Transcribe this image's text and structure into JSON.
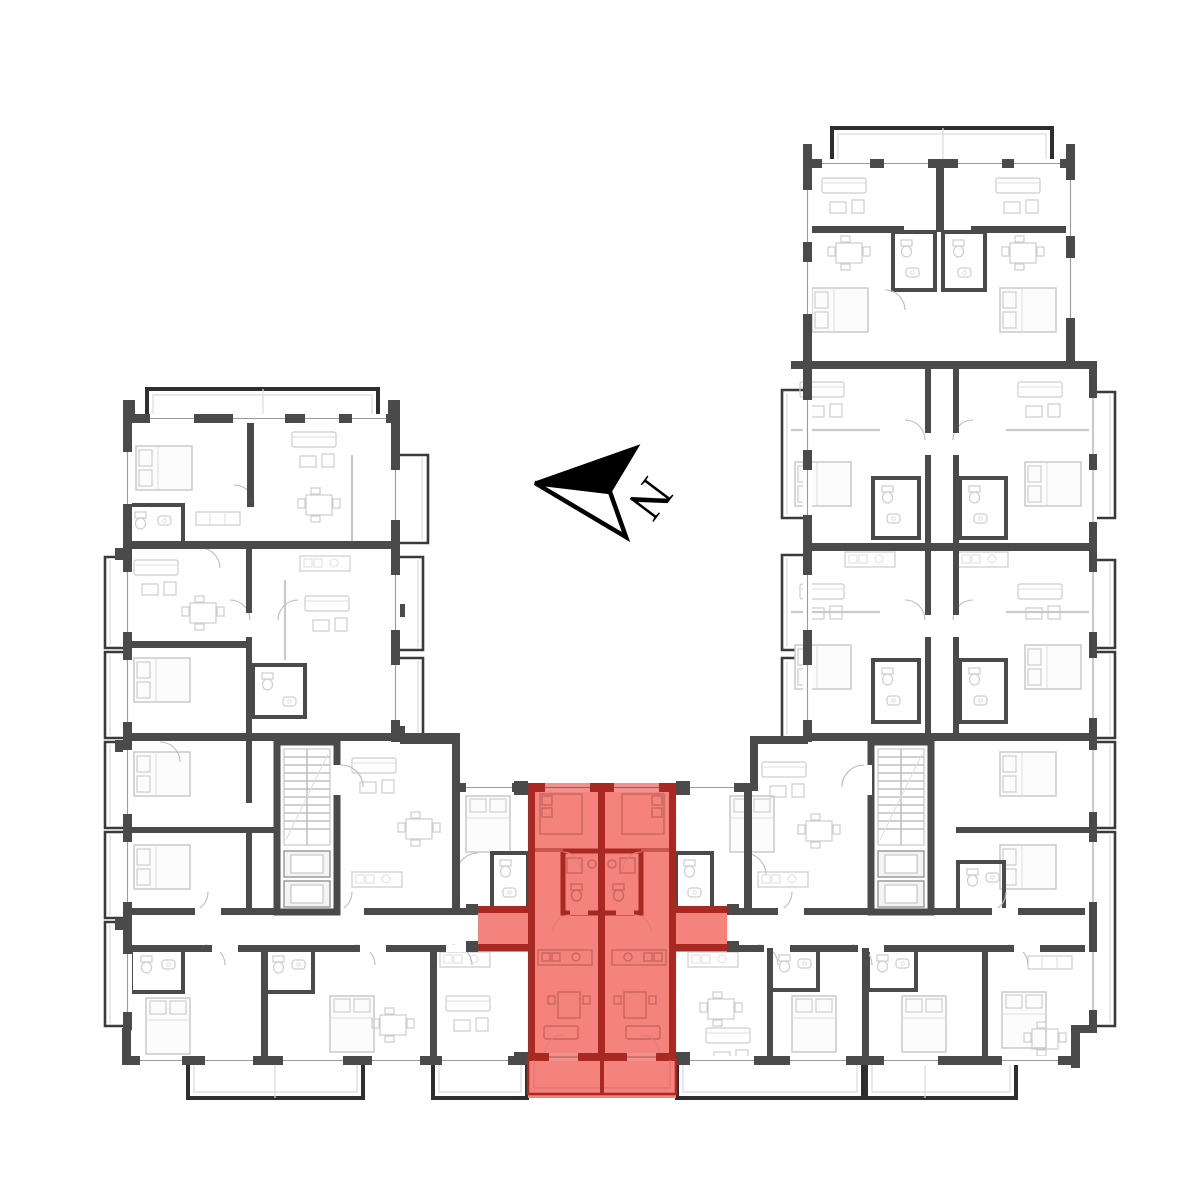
{
  "title": "Residential building floor plan",
  "compass": {
    "label": "N"
  },
  "floorplan": {
    "background_color": "#ffffff",
    "wall_color": "#4a4a4a",
    "furniture_line_color": "#c6c6c6",
    "highlight_fill_color": "#f4827d",
    "highlight_wall_color": "#a82822",
    "highlighted_unit": {
      "state": "selected",
      "location": "bottom-center",
      "has_balcony": true
    }
  }
}
